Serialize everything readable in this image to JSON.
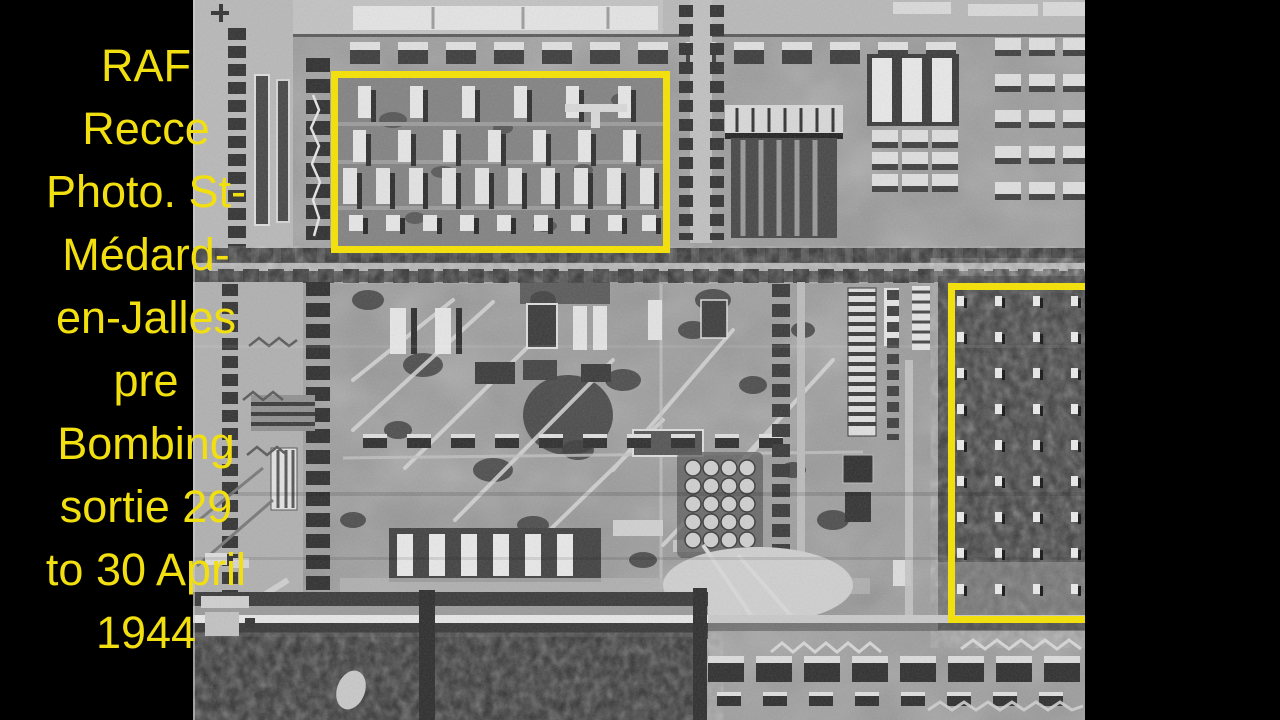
{
  "frame": {
    "width": 1280,
    "height": 720,
    "background": "#000000"
  },
  "caption": {
    "color": "#f2df10",
    "full_text": "RAF Recce Photo. St-Médard-en-Jalles pre Bombing sortie 29 to 30 April 1944",
    "lines": [
      "RAF",
      "Recce",
      "Photo. St-",
      "Médard-",
      "en-Jalles",
      "pre",
      "Bombing",
      "sortie 29",
      "to 30 April",
      "1944"
    ]
  },
  "photo": {
    "kind": "black-and-white aerial reconnaissance photograph",
    "annotations": [
      {
        "name": "barracks-area-box",
        "shape": "rectangle",
        "color": "#f2df10"
      },
      {
        "name": "wooded-storage-area-box",
        "shape": "rectangle",
        "color": "#f2df10"
      }
    ]
  }
}
